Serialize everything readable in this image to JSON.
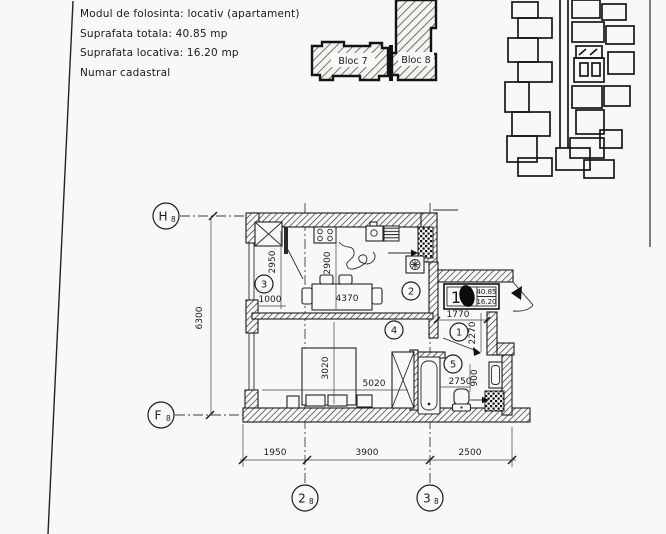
{
  "info": {
    "line1": "Modul de folosinta: locativ (apartament)",
    "line2": "Suprafata totala: 40.85 mp",
    "line3": "Suprafata locativa: 16.20 mp",
    "line4": "Numar cadastral"
  },
  "site": {
    "bloc7": "Bloc 7",
    "bloc8": "Bloc 8"
  },
  "plan": {
    "grid": {
      "h": "H",
      "f": "F",
      "c2": "2",
      "c3": "3",
      "sub": "8"
    },
    "rooms": {
      "r1": "1",
      "r2": "2",
      "r3": "3",
      "r4": "4",
      "r5": "5"
    },
    "dims": {
      "w1": "1950",
      "w2": "3900",
      "w3": "2500",
      "height": "6300",
      "room3_h": "2950",
      "room3_w": "1000",
      "kitchen_h": "2900",
      "table": "4370",
      "bed_h": "3020",
      "living_w": "5020",
      "bath_w": "2750",
      "bath_niche": "900",
      "hall_w": "1770",
      "hall_h": "2270"
    },
    "tag": {
      "unit": "1",
      "total": "40.85",
      "living": "16.20"
    }
  }
}
